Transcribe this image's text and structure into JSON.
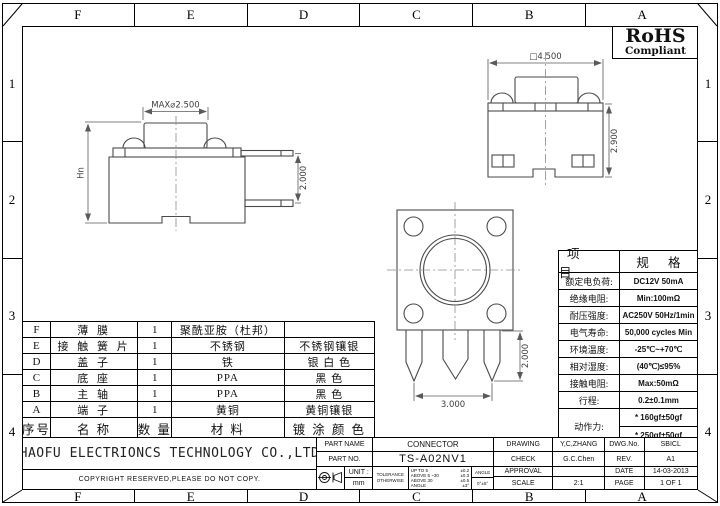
{
  "frame": {
    "col_labels": [
      "F",
      "E",
      "D",
      "C",
      "B",
      "A"
    ],
    "row_labels": [
      "1",
      "2",
      "3",
      "4"
    ]
  },
  "rohs": {
    "line1": "RoHS",
    "line2": "Compliant"
  },
  "views": {
    "side": {
      "dim_top": "MAX⌀2.500",
      "dim_left": "Hn",
      "dim_right": "2.000"
    },
    "front": {
      "dim_top": "□4.500",
      "dim_right": "2.900"
    },
    "bottom": {
      "dim_bottom": "3.000",
      "dim_right": "2.000"
    }
  },
  "spec_table": {
    "header": {
      "item": "项 目",
      "spec": "规 格"
    },
    "rows": [
      {
        "item": "额定电负荷:",
        "spec": "DC12V 50mA"
      },
      {
        "item": "绝缘电阻:",
        "spec": "Min:100mΩ"
      },
      {
        "item": "耐压强度:",
        "spec": "AC250V 50Hz/1min"
      },
      {
        "item": "电气寿命:",
        "spec": "50,000 cycles Min"
      },
      {
        "item": "环境温度:",
        "spec": "-25℃~+70℃"
      },
      {
        "item": "相对湿度:",
        "spec": "(40℃)≤95%"
      },
      {
        "item": "接触电阻:",
        "spec": "Max:50mΩ"
      },
      {
        "item": "行程:",
        "spec": "0.2±0.1mm"
      },
      {
        "item": "动作力:",
        "spec": "* 160gf±50gf",
        "spec2": "* 250gf±50gf"
      }
    ]
  },
  "parts_table": {
    "header": {
      "no": "序号",
      "name": "名 称",
      "qty": "数 量",
      "material": "材 料",
      "finish": "镀 涂 颜 色"
    },
    "rows": [
      {
        "no": "F",
        "name": "薄 膜",
        "qty": "1",
        "material": "聚酰亚胺（杜邦）",
        "finish": ""
      },
      {
        "no": "E",
        "name": "接 触 簧 片",
        "qty": "1",
        "material": "不锈钢",
        "finish": "不锈钢镶银"
      },
      {
        "no": "D",
        "name": "盖 子",
        "qty": "1",
        "material": "铁",
        "finish": "银 白 色"
      },
      {
        "no": "C",
        "name": "底 座",
        "qty": "1",
        "material": "PPA",
        "finish": "黑 色"
      },
      {
        "no": "B",
        "name": "主 轴",
        "qty": "1",
        "material": "PPA",
        "finish": "黑 色"
      },
      {
        "no": "A",
        "name": "端 子",
        "qty": "1",
        "material": "黄铜",
        "finish": "黄铜镶银"
      }
    ]
  },
  "title_block": {
    "company": "HAOFU ELECTRIONCS TECHNOLOGY CO.,LTD",
    "copyright": "COPYRIGHT RESERVED,PLEASE DO NOT COPY.",
    "part_name_label": "PART NAME",
    "part_name": "CONNECTOR",
    "part_no_label": "PART NO.",
    "part_no": "TS-A02NV1",
    "unit_label": "UNIT :",
    "unit": "mm",
    "tolerance_label1": "TOLERANCE",
    "tolerance_label2": "OTHERWISE",
    "tolerances": [
      [
        "UP TO 5",
        "±0.2"
      ],
      [
        "ABOVE 5 ~30",
        "±0.3"
      ],
      [
        "ABOVE 30",
        "±0.5"
      ],
      [
        "ANGLE",
        "±3°"
      ]
    ],
    "angle_label": "ANGLE",
    "angle_value": "0°±5°",
    "drawing_label": "DRAWING",
    "drawing": "Y,C,ZHANG",
    "check_label": "CHECK",
    "check": "G.C.Chen",
    "approval_label": "APPROVAL",
    "approval": "",
    "scale_label": "SCALE",
    "scale": "2:1",
    "dwg_no_label": "DWG.No.",
    "dwg_no": "SBICL",
    "rev_label": "REV.",
    "rev": "A1",
    "date_label": "DATE",
    "date": "14-03-2013",
    "page_label": "PAGE",
    "page": "1 OF 1"
  },
  "colors": {
    "line": "#4a4a4a",
    "dim": "#5a5a5a",
    "text": "#111111"
  }
}
